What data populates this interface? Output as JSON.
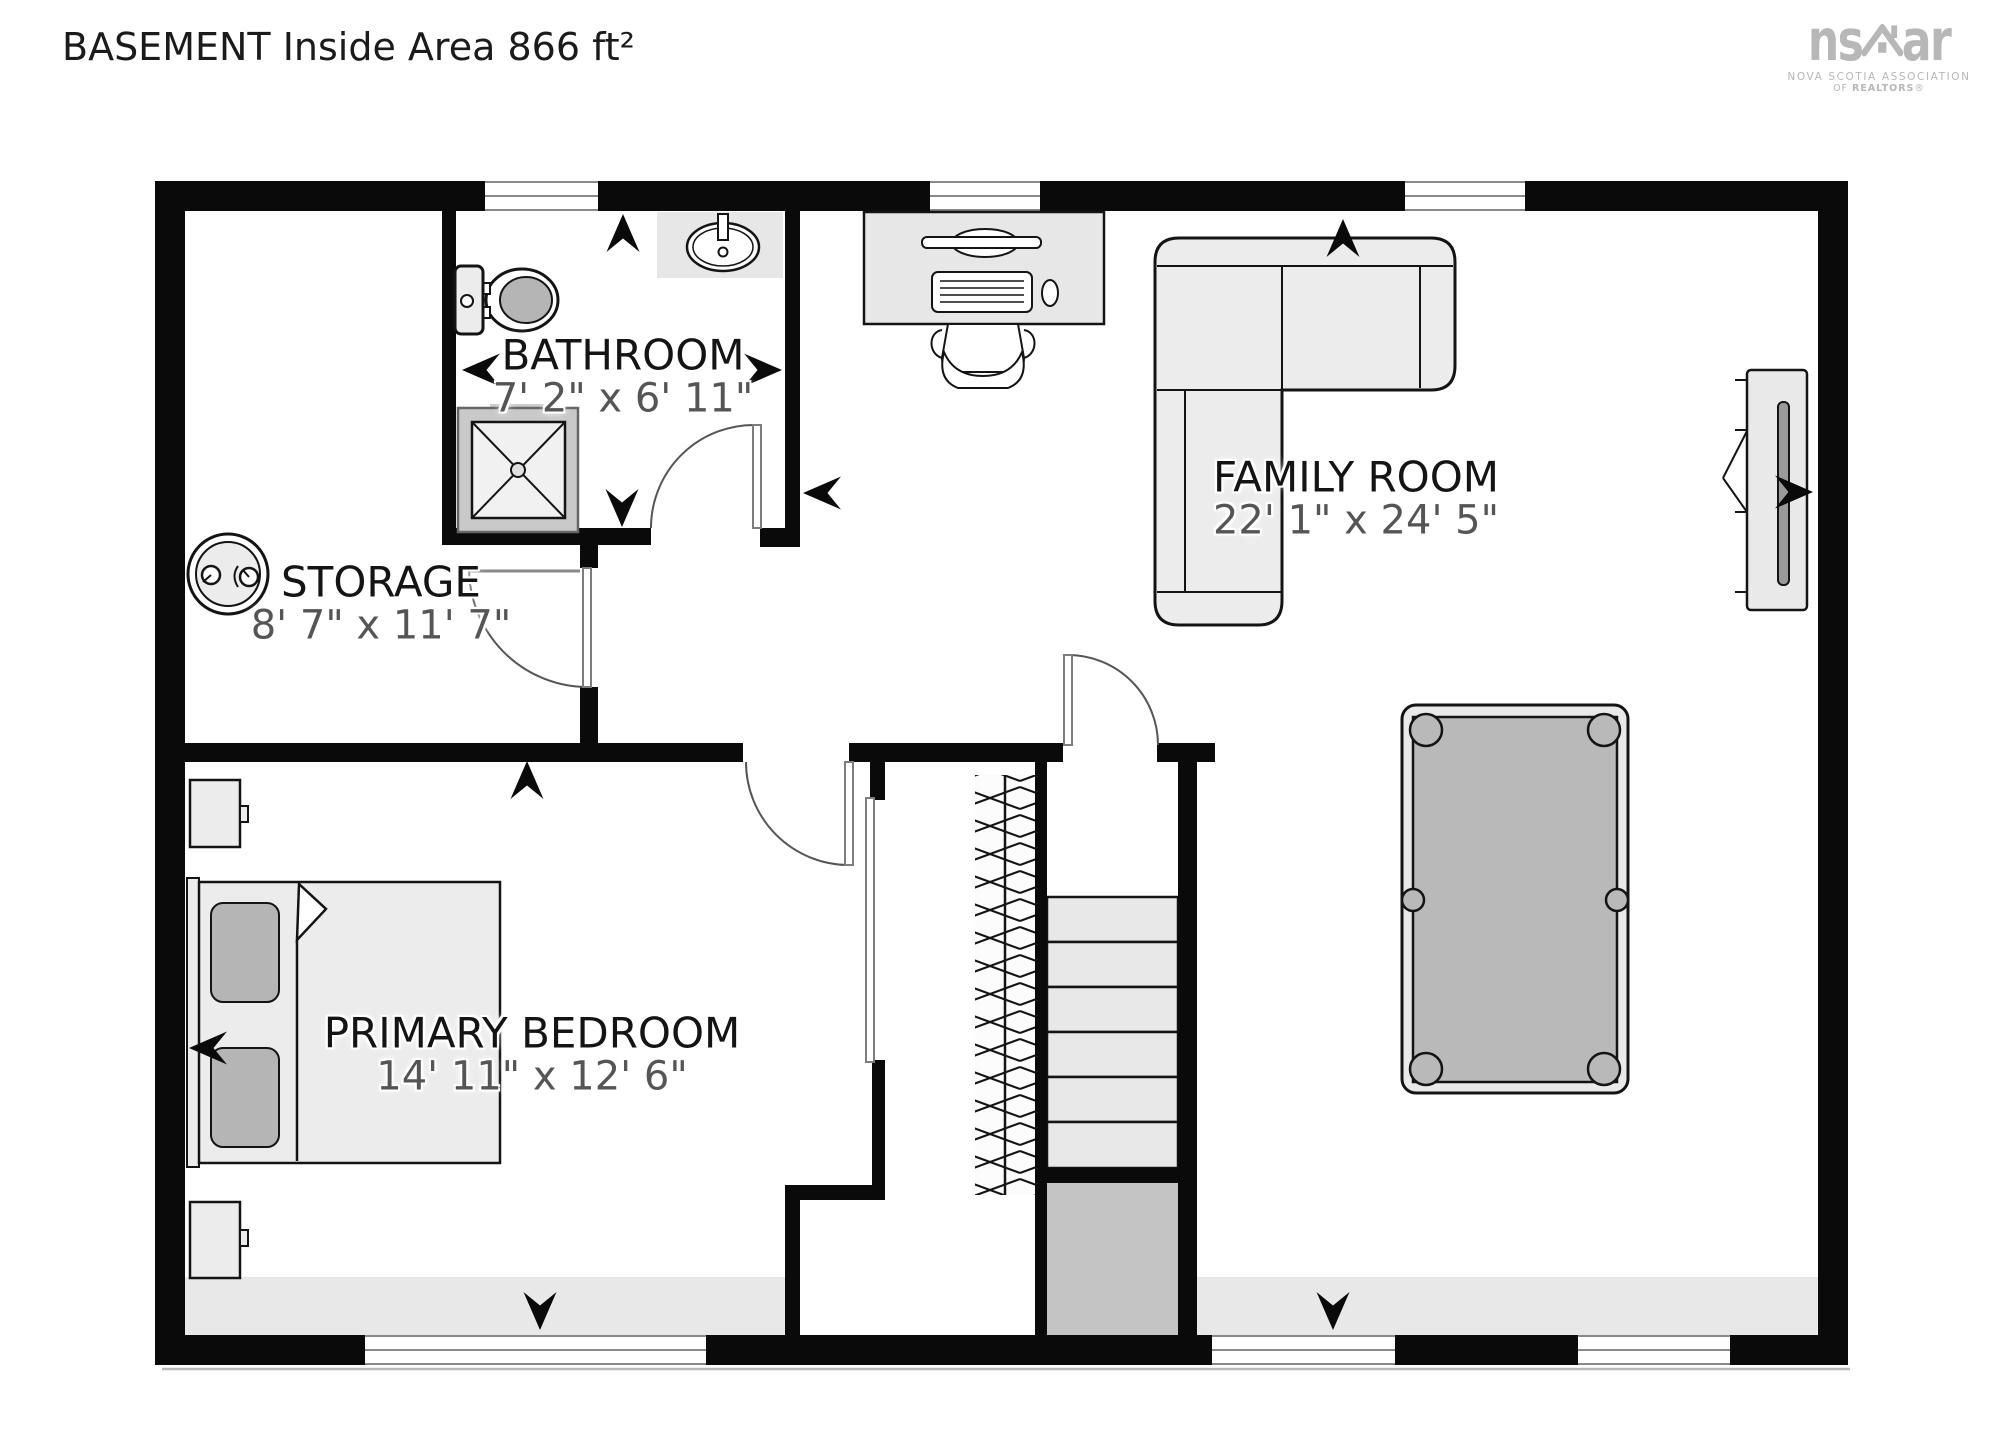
{
  "title": "BASEMENT Inside Area 866 ft²",
  "logo": {
    "brand_left": "ns",
    "brand_right": "ar",
    "tagline_line1": "NOVA SCOTIA ASSOCIATION",
    "tagline_line2_prefix": "OF ",
    "tagline_line2_brand": "REALTORS",
    "tagline_line2_reg": "®"
  },
  "rooms": {
    "bathroom": {
      "name": "BATHROOM",
      "dims": "7' 2\" x 6' 11\""
    },
    "storage": {
      "name": "STORAGE",
      "dims": "8' 7\" x 11' 7\""
    },
    "family_room": {
      "name": "FAMILY ROOM",
      "dims": "22' 1\" x 24' 5\""
    },
    "primary_bedroom": {
      "name": "PRIMARY BEDROOM",
      "dims": "14' 11\" x 12' 6\""
    }
  }
}
